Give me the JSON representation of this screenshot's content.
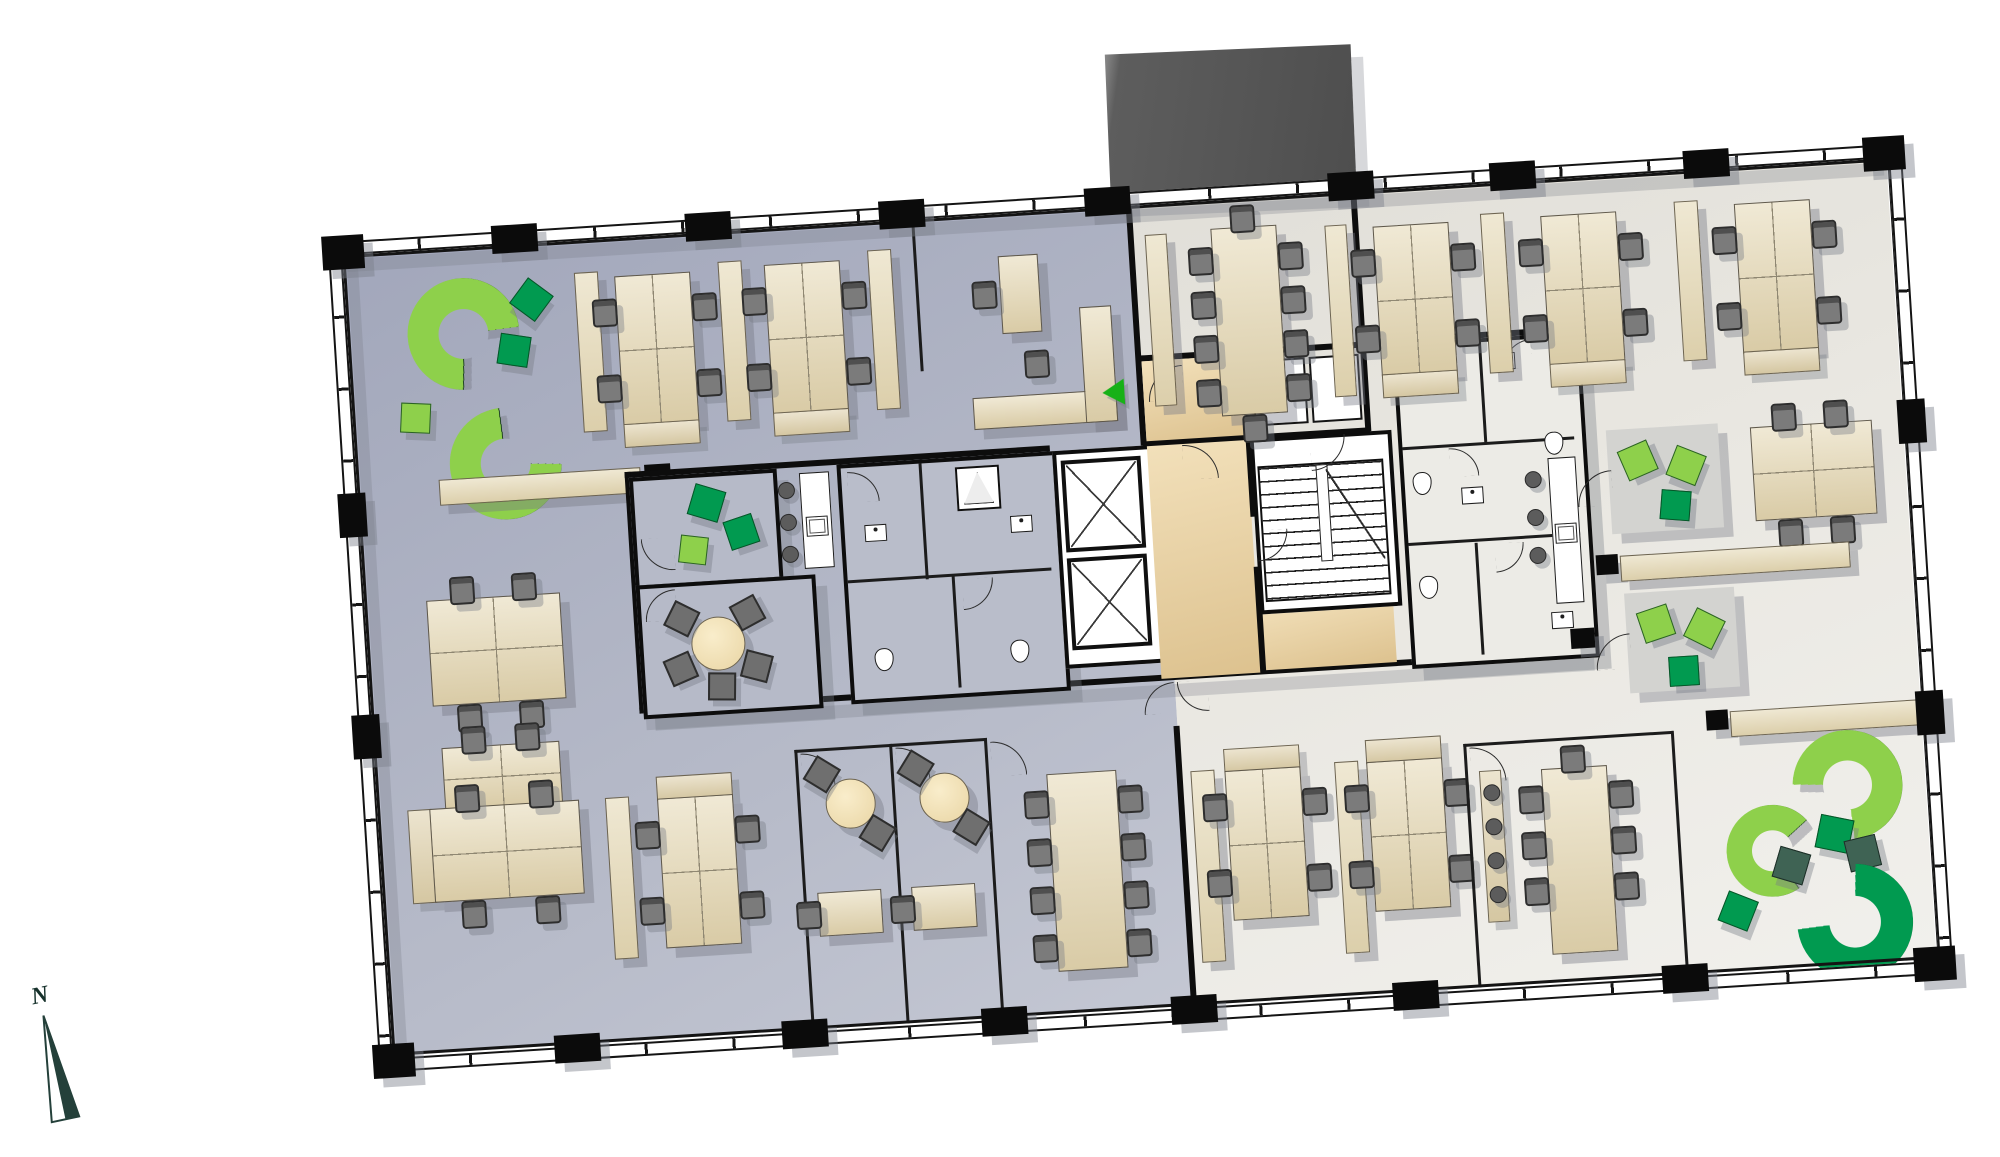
{
  "diagram": {
    "type": "office-floor-plan",
    "rotation_deg": -3.6,
    "text_on_image": [
      "N"
    ]
  },
  "compass": {
    "label": "N"
  },
  "palette": {
    "west_floor": "#b7bbc9",
    "east_floor": "#e9e7e1",
    "lobby_floor": "#ecd6a5",
    "structure_black": "#0d0d0d",
    "desk_beige": "#e5dabb",
    "chair_gray": "#7b7b7b",
    "sofa_light_green": "#8ed04b",
    "pouf_green": "#019a50",
    "pouf_teal": "#3f6354",
    "entry_arrow_green": "#17b117",
    "annex_roof_gray": "#565656",
    "shadow": "rgba(118,122,133,0.42)"
  },
  "zones": [
    {
      "name": "northwest-open-office",
      "floor": "west_floor",
      "furniture": [
        {
          "item": "curved-sofa",
          "count": 2
        },
        {
          "item": "diamond-pouf",
          "count": 3
        },
        {
          "item": "desk-cluster-of-4",
          "count": 2
        },
        {
          "item": "sideboard",
          "count": 3
        },
        {
          "item": "single-desk",
          "count": 1
        },
        {
          "item": "l-shaped-counter",
          "count": 1
        },
        {
          "item": "task-chair",
          "count": 10
        }
      ]
    },
    {
      "name": "west-wall-area",
      "floor": "west_floor",
      "furniture": [
        {
          "item": "sideboard",
          "count": 2
        },
        {
          "item": "meeting-table-4-seats",
          "count": 1
        },
        {
          "item": "duo-desk",
          "count": 1
        },
        {
          "item": "task-chair",
          "count": 6
        }
      ]
    },
    {
      "name": "southwest-open-office",
      "floor": "west_floor",
      "furniture": [
        {
          "item": "desk-cluster-of-4",
          "count": 2
        },
        {
          "item": "sideboard",
          "count": 1
        },
        {
          "item": "task-chair",
          "count": 8
        }
      ]
    },
    {
      "name": "focus-booths",
      "floor": "west_floor",
      "count": 2,
      "furniture": [
        {
          "item": "round-table",
          "count": 2
        },
        {
          "item": "diamond-chair",
          "count": 4
        },
        {
          "item": "desk",
          "count": 2
        },
        {
          "item": "task-chair",
          "count": 2
        }
      ]
    },
    {
      "name": "southwest-meeting-room",
      "floor": "west_floor",
      "furniture": [
        {
          "item": "meeting-table-8-seats",
          "count": 1
        }
      ]
    },
    {
      "name": "central-core",
      "floor": "white",
      "furniture": [
        {
          "item": "elevator-shaft",
          "count": 2
        },
        {
          "item": "staircase",
          "count": 1
        },
        {
          "item": "restroom-block",
          "count": 2
        },
        {
          "item": "shower",
          "count": 2
        },
        {
          "item": "toilet",
          "count": 5
        },
        {
          "item": "sink",
          "count": 5
        },
        {
          "item": "pouf-lounge-room",
          "count": 1
        },
        {
          "item": "round-meeting-table",
          "count": 1
        },
        {
          "item": "coffee-counter-with-stools",
          "count": 2
        },
        {
          "item": "elevator-lobby",
          "count": 1
        }
      ]
    },
    {
      "name": "north-meeting-room",
      "floor": "east_floor",
      "furniture": [
        {
          "item": "meeting-table-10-seats",
          "count": 1
        },
        {
          "item": "sideboard",
          "count": 2
        }
      ]
    },
    {
      "name": "northeast-open-office",
      "floor": "east_floor",
      "furniture": [
        {
          "item": "desk-cluster-of-4",
          "count": 3
        },
        {
          "item": "sideboard",
          "count": 2
        },
        {
          "item": "task-chair",
          "count": 12
        }
      ]
    },
    {
      "name": "east-lounge-area",
      "floor": "east_floor",
      "furniture": [
        {
          "item": "lounge-mat",
          "count": 2
        },
        {
          "item": "diamond-pouf",
          "count": 6
        },
        {
          "item": "table-4-seats",
          "count": 1
        },
        {
          "item": "sideboard",
          "count": 2
        }
      ]
    },
    {
      "name": "southeast-open-office",
      "floor": "east_floor",
      "furniture": [
        {
          "item": "desk-cluster-of-4",
          "count": 2
        },
        {
          "item": "sideboard",
          "count": 2
        },
        {
          "item": "meeting-room-8-seats-with-bench",
          "count": 1
        },
        {
          "item": "bench-stool",
          "count": 4
        }
      ]
    },
    {
      "name": "southeast-lounge",
      "floor": "east_floor",
      "furniture": [
        {
          "item": "curved-sofa",
          "count": 3
        },
        {
          "item": "diamond-pouf",
          "count": 4
        },
        {
          "item": "sideboard",
          "count": 1
        }
      ]
    },
    {
      "name": "roof-annex",
      "floor": "annex_roof_gray",
      "furniture": []
    },
    {
      "name": "entrances",
      "markers": [
        {
          "item": "green-arrow-left",
          "count": 1
        },
        {
          "item": "green-arrow-right",
          "count": 1
        }
      ]
    }
  ]
}
